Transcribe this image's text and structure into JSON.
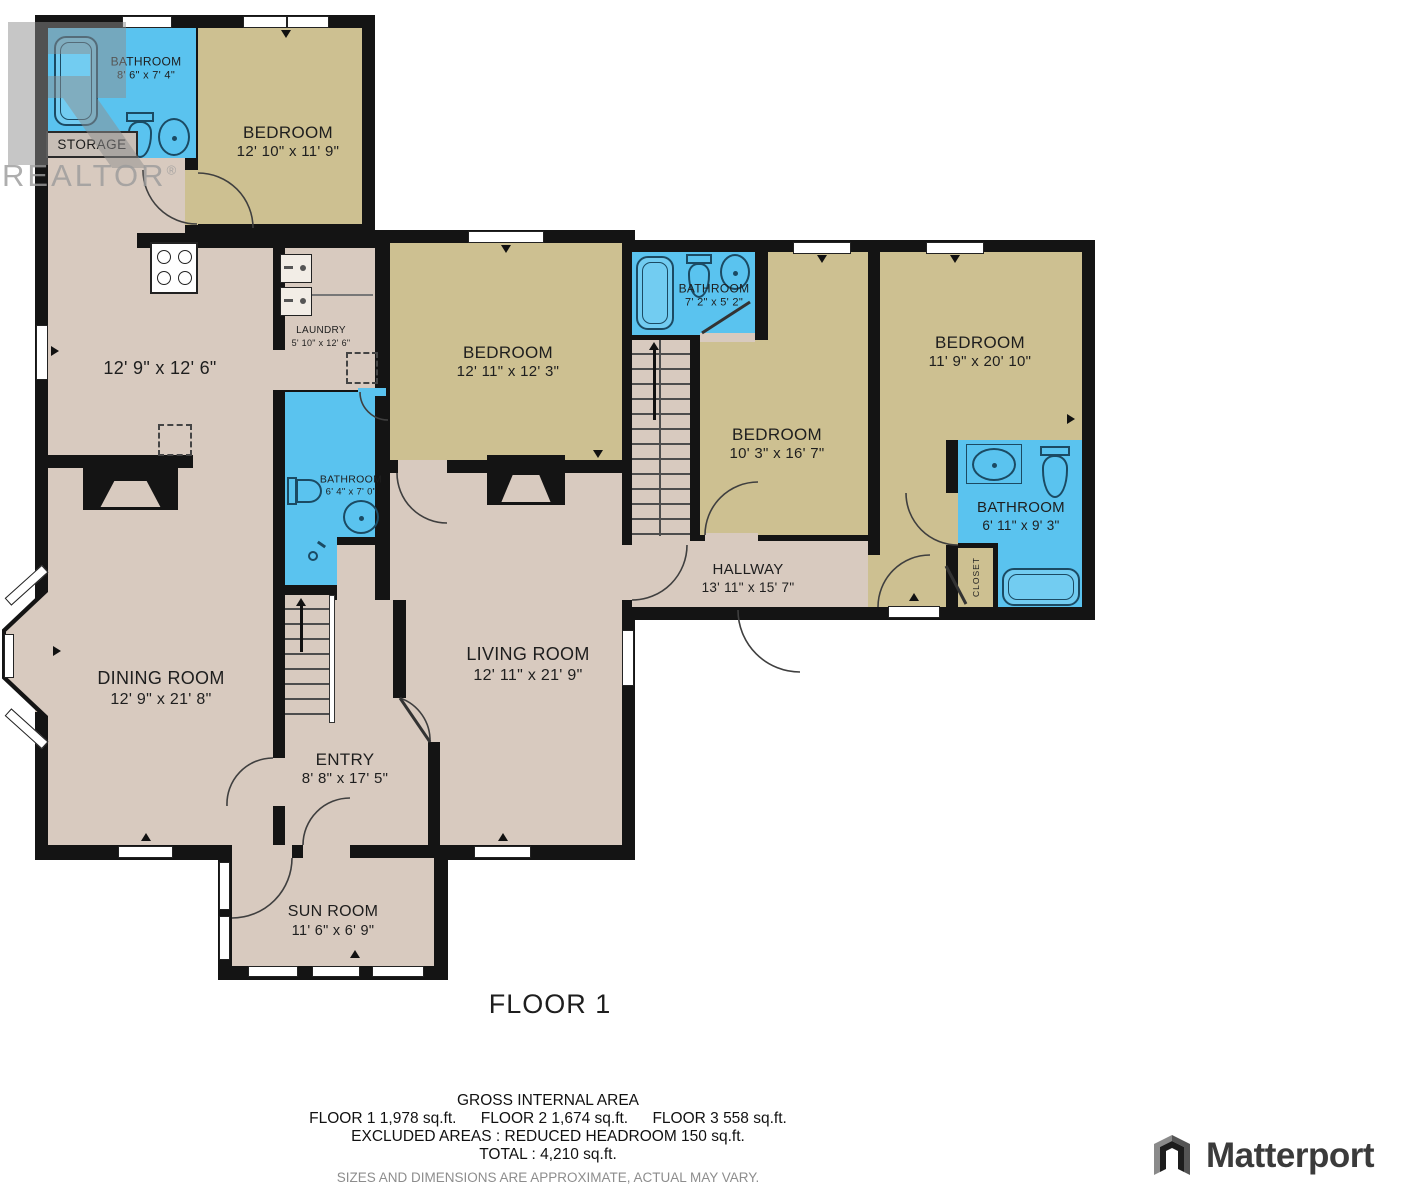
{
  "plan": {
    "floor_label": "FLOOR 1",
    "storage_label": "STORAGE",
    "closet_label": "CLOSET",
    "rooms": [
      {
        "id": "bathroom-top-left",
        "name": "BATHROOM",
        "dims": "8' 6\" x 7' 4\""
      },
      {
        "id": "bedroom-top-left",
        "name": "BEDROOM",
        "dims": "12' 10\" x 11' 9\""
      },
      {
        "id": "kitchen",
        "name": "",
        "dims": "12' 9\" x 12' 6\""
      },
      {
        "id": "laundry",
        "name": "LAUNDRY",
        "dims": "5' 10\" x 12' 6\""
      },
      {
        "id": "bathroom-middle",
        "name": "BATHROOM",
        "dims": "6' 4\" x 7' 0\""
      },
      {
        "id": "bedroom-center",
        "name": "BEDROOM",
        "dims": "12' 11\" x 12' 3\""
      },
      {
        "id": "bathroom-upper",
        "name": "BATHROOM",
        "dims": "7' 2\" x 5' 2\""
      },
      {
        "id": "bedroom-mid-right",
        "name": "BEDROOM",
        "dims": "10' 3\" x 16' 7\""
      },
      {
        "id": "bedroom-right",
        "name": "BEDROOM",
        "dims": "11' 9\" x 20' 10\""
      },
      {
        "id": "bathroom-right",
        "name": "BATHROOM",
        "dims": "6' 11\" x 9' 3\""
      },
      {
        "id": "hallway",
        "name": "HALLWAY",
        "dims": "13' 11\" x 15' 7\""
      },
      {
        "id": "dining-room",
        "name": "DINING ROOM",
        "dims": "12' 9\" x 21' 8\""
      },
      {
        "id": "living-room",
        "name": "LIVING ROOM",
        "dims": "12' 11\" x 21' 9\""
      },
      {
        "id": "entry",
        "name": "ENTRY",
        "dims": "8' 8\" x 17' 5\""
      },
      {
        "id": "sun-room",
        "name": "SUN ROOM",
        "dims": "11' 6\" x 6' 9\""
      }
    ]
  },
  "summary": {
    "title": "GROSS INTERNAL AREA",
    "floor1": "FLOOR 1 1,978 sq.ft.",
    "floor2": "FLOOR 2 1,674 sq.ft.",
    "floor3": "FLOOR 3 558 sq.ft.",
    "excluded": "EXCLUDED AREAS : REDUCED HEADROOM 150 sq.ft.",
    "total": "TOTAL : 4,210 sq.ft.",
    "disclaimer": "SIZES AND DIMENSIONS ARE APPROXIMATE, ACTUAL MAY VARY."
  },
  "watermark": {
    "realtor": "REALTOR",
    "reg": "®"
  },
  "branding": {
    "matterport": "Matterport"
  },
  "colors": {
    "wall": "#141414",
    "floor_taupe": "#d8cabf",
    "floor_khaki": "#cdc091",
    "bathroom_blue": "#5ac3ef",
    "fixture_stroke": "#1b4a63",
    "watermark_gray": "#9b9b9b",
    "disclaimer_gray": "#8d8d8d",
    "logo_dark": "#3b3b3b"
  }
}
